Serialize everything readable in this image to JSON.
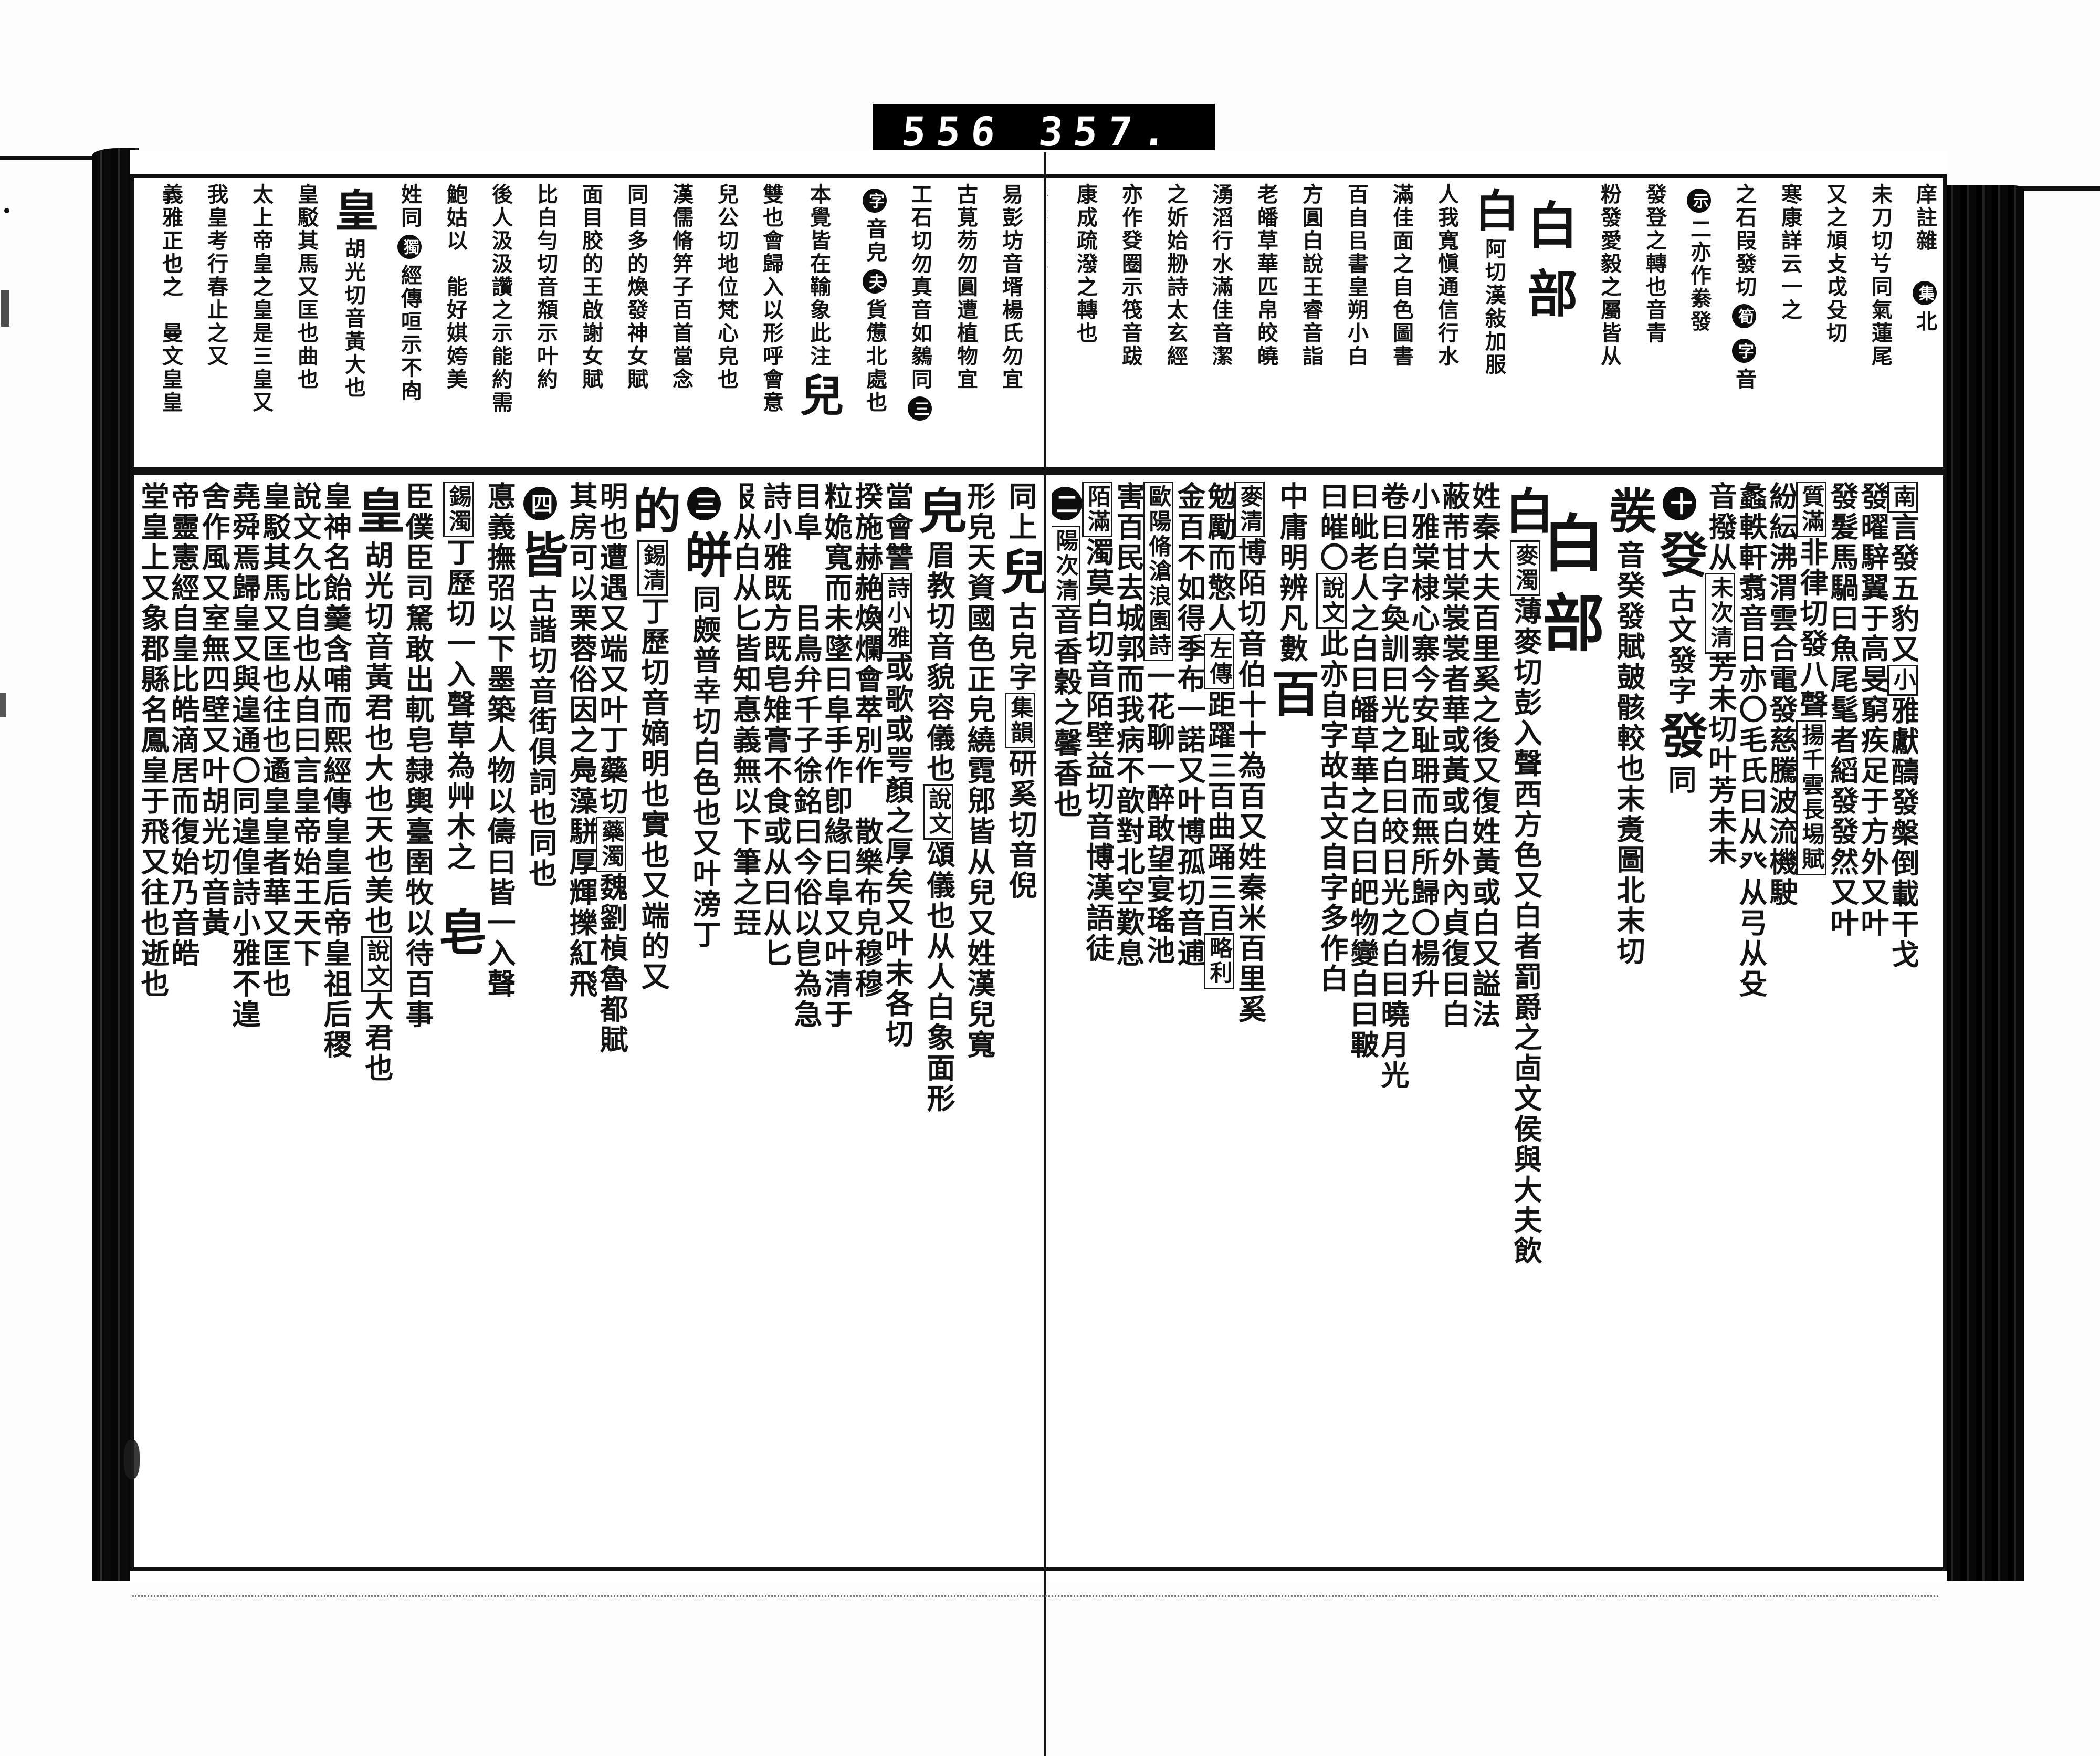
{
  "scan_label": {
    "left_number": "556",
    "right_number": "357."
  },
  "colors": {
    "ink": "#131313",
    "paper": "#ffffff",
    "label_bg": "#000000",
    "label_fg": "#ffffff"
  },
  "book": {
    "right_page": {
      "band_columns": [
        [
          {
            "k": "s",
            "t": "庠註雜𠦜"
          },
          {
            "k": "c",
            "t": "集"
          },
          {
            "k": "s",
            "t": "北"
          }
        ],
        [
          {
            "k": "s",
            "t": "未刀切𠔃同氣蓮尾"
          }
        ],
        [
          {
            "k": "s",
            "t": "又之頄攴戉殳切"
          }
        ],
        [
          {
            "k": "s",
            "t": "寒康詳云一之"
          }
        ],
        [
          {
            "k": "s",
            "t": "之石叚發切"
          },
          {
            "k": "c",
            "t": "筍"
          },
          {
            "k": "c",
            "t": "字"
          },
          {
            "k": "s",
            "t": "音"
          }
        ],
        [
          {
            "k": "c",
            "t": "示"
          },
          {
            "k": "s",
            "t": "二亦作絭發"
          }
        ],
        [
          {
            "k": "s",
            "t": "發登之轉也音青"
          }
        ],
        [
          {
            "k": "s",
            "t": "粉發愛毅之屬皆从"
          }
        ],
        [
          {
            "k": "h",
            "t": "白部"
          }
        ],
        [
          {
            "k": "b",
            "t": "白"
          },
          {
            "k": "s",
            "t": "阿切漢敍加服"
          }
        ],
        [
          {
            "k": "s",
            "t": "人我寬愼通信行水"
          }
        ],
        [
          {
            "k": "s",
            "t": "滿佳面之自色圖書"
          }
        ],
        [
          {
            "k": "s",
            "t": "百自㠯書皇朔小白"
          }
        ],
        [
          {
            "k": "s",
            "t": "方圓白說王睿音詣"
          }
        ],
        [
          {
            "k": "s",
            "t": "老皤草華匹帛皎皢"
          }
        ],
        [
          {
            "k": "s",
            "t": "湧滔行水滿佳音潔"
          }
        ],
        [
          {
            "k": "s",
            "t": "之妡姶刱詩太玄經"
          }
        ],
        [
          {
            "k": "s",
            "t": "亦作癹圈示筏音跋"
          }
        ],
        [
          {
            "k": "s",
            "t": "康成疏潑之轉也"
          }
        ]
      ],
      "body_columns": [
        [
          {
            "k": "x",
            "t": "南"
          },
          {
            "k": "s",
            "t": "言發五豹又"
          },
          {
            "k": "x",
            "t": "小"
          },
          {
            "k": "s",
            "t": "雅獻醻發槃倒載干戈"
          }
        ],
        [
          {
            "k": "s",
            "t": "發曜騂翼于高旻窮疾足于方外又叶"
          }
        ],
        [
          {
            "k": "s",
            "t": "發髮馬騧曰魚尾髦者縚發發然又叶"
          }
        ],
        [
          {
            "k": "x",
            "t": "質滿"
          },
          {
            "k": "s",
            "t": "非律切發八聲"
          },
          {
            "k": "x",
            "t": "揚千雲長埸賦"
          }
        ],
        [
          {
            "k": "s",
            "t": "紛紜沸渭雲合電發慈騰波流機駛"
          }
        ],
        [
          {
            "k": "s",
            "t": "蠡軼軒翥音日亦〇毛氏曰从癶从弓从殳"
          }
        ],
        [
          {
            "k": "s",
            "t": "音撥从"
          },
          {
            "k": "x",
            "t": "未次清"
          },
          {
            "k": "s",
            "t": "芳未切叶芳未未"
          }
        ],
        [
          {
            "k": "c",
            "t": "十"
          },
          {
            "k": "b",
            "t": "癹"
          },
          {
            "k": "s",
            "t": "古文發字"
          },
          {
            "k": "b",
            "t": "發"
          },
          {
            "k": "s",
            "t": "同"
          }
        ],
        [
          {
            "k": "b",
            "t": "彂"
          },
          {
            "k": "s",
            "t": "音癸發賦皷骸較也末煑圖北末切"
          }
        ],
        [
          {
            "k": "h",
            "t": "白部"
          }
        ],
        [
          {
            "k": "b",
            "t": "白"
          },
          {
            "k": "x",
            "t": "麥濁"
          },
          {
            "k": "s",
            "t": "薄麥切彭入聲西方色又白者罰爵之㔽文侯與大夫飲"
          }
        ],
        [
          {
            "k": "s",
            "t": "姓秦大夫百里奚之後又復姓黃或白又謚法"
          }
        ],
        [
          {
            "k": "s",
            "t": "蔽芾甘棠裳裳者華或黃或白外內貞復曰白"
          }
        ],
        [
          {
            "k": "s",
            "t": "小雅棠棣心寨今安耻耼而無所歸〇楊升"
          }
        ],
        [
          {
            "k": "s",
            "t": "卷曰白字奐訓曰光之白曰皎日光之白曰曉月光"
          }
        ],
        [
          {
            "k": "s",
            "t": "曰皉老人之白曰皤草華之白曰皅物變白曰皸"
          }
        ],
        [
          {
            "k": "s",
            "t": "曰皠〇"
          },
          {
            "k": "x",
            "t": "說文"
          },
          {
            "k": "s",
            "t": "此亦自字故古文自字多作白"
          }
        ],
        [
          {
            "k": "s",
            "t": "中庸明辨凡數"
          },
          {
            "k": "b",
            "t": "百"
          }
        ],
        [
          {
            "k": "x",
            "t": "麥清"
          },
          {
            "k": "s",
            "t": "博陌切音伯十十為百又姓秦米百里奚"
          }
        ],
        [
          {
            "k": "s",
            "t": "勉勵而憼人"
          },
          {
            "k": "x",
            "t": "左傳"
          },
          {
            "k": "s",
            "t": "距躍三百曲踊三百"
          },
          {
            "k": "x",
            "t": "略利"
          }
        ],
        [
          {
            "k": "s",
            "t": "金百不如得季布一諾又叶博孤切音逋"
          }
        ],
        [
          {
            "k": "x",
            "t": "歐陽脩滄浪園詩"
          },
          {
            "k": "s",
            "t": "一花聊一醉敢望宴瑤池"
          }
        ],
        [
          {
            "k": "s",
            "t": "害百民去城郭而我病不歆對北空歎息"
          }
        ],
        [
          {
            "k": "x",
            "t": "陌滿"
          },
          {
            "k": "s",
            "t": "濁莫白切音陌壁益切音博漢語徒"
          }
        ],
        [
          {
            "k": "c",
            "t": "二"
          },
          {
            "k": "x",
            "t": "陽次清"
          },
          {
            "k": "s",
            "t": "音香穀之馨香也"
          }
        ]
      ]
    },
    "left_page": {
      "band_columns": [
        [
          {
            "k": "s",
            "t": "㣲行觀棋者白自"
          }
        ],
        [
          {
            "k": "s",
            "t": "易彭坊音壻楊氏勿宜"
          }
        ],
        [
          {
            "k": "s",
            "t": "古莧芴勿圓遭植物宜"
          }
        ],
        [
          {
            "k": "s",
            "t": "工石切勿真音如鶨同"
          },
          {
            "k": "c",
            "t": "三"
          }
        ],
        [
          {
            "k": "c",
            "t": "字"
          },
          {
            "k": "s",
            "t": "音皃"
          },
          {
            "k": "c",
            "t": "夫"
          },
          {
            "k": "s",
            "t": "貨憊北處也"
          }
        ],
        [
          {
            "k": "s",
            "t": "本覺皆在䩱象此注"
          },
          {
            "k": "b",
            "t": "兒"
          }
        ],
        [
          {
            "k": "s",
            "t": "雙也會歸入以形呼會意"
          }
        ],
        [
          {
            "k": "s",
            "t": "兒公切地位梵心皃也"
          }
        ],
        [
          {
            "k": "s",
            "t": "漢儒脩笄子百首當念"
          }
        ],
        [
          {
            "k": "s",
            "t": "同目多的煥發神女賦"
          }
        ],
        [
          {
            "k": "s",
            "t": "面目㬵的王啟謝女賦"
          }
        ],
        [
          {
            "k": "s",
            "t": "比白勻切音頮示叶約"
          }
        ],
        [
          {
            "k": "s",
            "t": "後人汲汲讚之示能約需"
          }
        ],
        [
          {
            "k": "s",
            "t": "鮑姑以𤓰能好娸姱美"
          }
        ],
        [
          {
            "k": "s",
            "t": "姓同"
          },
          {
            "k": "c",
            "t": "獨"
          },
          {
            "k": "s",
            "t": "經傳咺示不㕯"
          }
        ],
        [
          {
            "k": "b",
            "t": "皇"
          },
          {
            "k": "s",
            "t": "胡光切音黃大也"
          }
        ],
        [
          {
            "k": "s",
            "t": "皇駁其馬又匡也曲也"
          }
        ],
        [
          {
            "k": "s",
            "t": "太上帝皇之皇是三皇又"
          }
        ],
        [
          {
            "k": "s",
            "t": "我皇考行春止之又"
          }
        ],
        [
          {
            "k": "s",
            "t": "義雅正也之𦤼曼文皇皇"
          }
        ]
      ],
      "body_columns": [
        [
          {
            "k": "s",
            "t": "同上"
          },
          {
            "k": "b",
            "t": "兒"
          },
          {
            "k": "s",
            "t": "古皃字"
          },
          {
            "k": "x",
            "t": "集韻"
          },
          {
            "k": "s",
            "t": "研奚切音倪"
          }
        ],
        [
          {
            "k": "s",
            "t": "形皃天資國色正皃繞霓郳皆从兒又姓漢兒寬"
          }
        ],
        [
          {
            "k": "b",
            "t": "皃"
          },
          {
            "k": "s",
            "t": "眉教切音貌容儀也"
          },
          {
            "k": "x",
            "t": "說文"
          },
          {
            "k": "s",
            "t": "頌儀也从人白象面形"
          }
        ],
        [
          {
            "k": "s",
            "t": "當會讐"
          },
          {
            "k": "x",
            "t": "詩小雅"
          },
          {
            "k": "s",
            "t": "或歌或咢顏之厚矣又叶末各切"
          }
        ],
        [
          {
            "k": "s",
            "t": "揆施赫赩煥爛會萃別作𤿤散樂布皃穆穆"
          }
        ],
        [
          {
            "k": "s",
            "t": "粒姽寬而未墜曰阜手作卽緣曰阜又叶清于"
          }
        ],
        [
          {
            "k": "s",
            "t": "目阜𦯧𨾚㠯鳥弁千子徐銘曰今俗以皀為急"
          }
        ],
        [
          {
            "k": "s",
            "t": "詩小雅既方既皂雉膏不食或从曰从匕"
          }
        ],
        [
          {
            "k": "s",
            "t": "𠬝从白从匕皆知惪義無以下筆之㠭"
          }
        ],
        [
          {
            "k": "c",
            "t": "三"
          },
          {
            "k": "b",
            "t": "皏"
          },
          {
            "k": "s",
            "t": "同㿵普幸切白色也又叶滂丁"
          }
        ],
        [
          {
            "k": "b",
            "t": "的"
          },
          {
            "k": "x",
            "t": "錫清"
          },
          {
            "k": "s",
            "t": "丁歷切音嫡明也實也又端的又"
          }
        ],
        [
          {
            "k": "s",
            "t": "明也遭遇又端又叶丁藥切"
          },
          {
            "k": "x",
            "t": "藥濁"
          },
          {
            "k": "s",
            "t": "魏劉楨魯都賦"
          }
        ],
        [
          {
            "k": "s",
            "t": "其房可以栗蓉俗因之鳧藻駢厚輝擽紅飛"
          }
        ],
        [
          {
            "k": "c",
            "t": "四"
          },
          {
            "k": "b",
            "t": "皆"
          },
          {
            "k": "s",
            "t": "古諧切音街俱詞也同也"
          }
        ],
        [
          {
            "k": "s",
            "t": "悳義撫弨以下墨築人物以儔曰皆一入聲"
          }
        ],
        [
          {
            "k": "x",
            "t": "錫濁"
          },
          {
            "k": "s",
            "t": "丁歷切一入聲草為艸木之𦯧"
          },
          {
            "k": "b",
            "t": "皂"
          }
        ],
        [
          {
            "k": "s",
            "t": "臣僕臣司駑敢出軏皂隸輿臺圉牧以待百事"
          }
        ],
        [
          {
            "k": "b",
            "t": "皇"
          },
          {
            "k": "s",
            "t": "胡光切音黃君也大也天也美也"
          },
          {
            "k": "x",
            "t": "說文"
          },
          {
            "k": "s",
            "t": "大君也"
          }
        ],
        [
          {
            "k": "s",
            "t": "皇神名飴羹含哺而熙經傳皇皇后帝皇祖后稷"
          }
        ],
        [
          {
            "k": "s",
            "t": "說文久比自也从自曰言皇帝始王天下"
          }
        ],
        [
          {
            "k": "s",
            "t": "皇駁其馬又匡也往也遹皇皇者華又匡也"
          }
        ],
        [
          {
            "k": "s",
            "t": "堯舜焉歸皇又與遑通〇同遑偟詩小雅不遑"
          }
        ],
        [
          {
            "k": "s",
            "t": "舍作風又室無四壁又叶胡光切音黃"
          }
        ],
        [
          {
            "k": "s",
            "t": "帝靈憲經自皇比皓滴居而復始乃音皓"
          }
        ],
        [
          {
            "k": "s",
            "t": "堂皇上又象郡縣名鳳皇于飛又往也逝也"
          }
        ]
      ]
    }
  }
}
